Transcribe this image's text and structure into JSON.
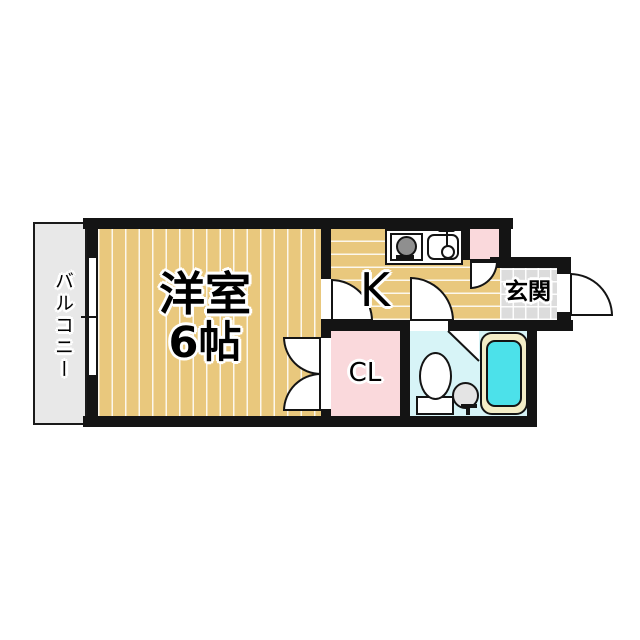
{
  "rooms": {
    "main": {
      "line1": "洋室",
      "line2": "6帖",
      "floor_color": "#e9c87d"
    },
    "kitchen": {
      "label": "K",
      "floor_color": "#e9c87d"
    },
    "closet": {
      "label": "CL",
      "floor_color": "#fad9dc"
    },
    "entrance": {
      "label": "玄関",
      "floor_color": "#dcdcdc"
    },
    "balcony": {
      "label": "バルコニー",
      "floor_color": "#e8e8e8"
    },
    "bathroom": {
      "floor_color": "#d7f4f7"
    },
    "storage_box": {
      "floor_color": "#fad9dc"
    }
  },
  "fixtures": {
    "kitchen_icons": [
      "stove-icon",
      "sink-icon",
      "faucet-icon"
    ],
    "bathroom_icons": [
      "toilet-icon",
      "washbasin-icon",
      "bathtub-icon"
    ],
    "bathtub_water_color": "#4ce1ea",
    "bathtub_rim_color": "#f3edc7",
    "stove_burner_color": "#8f8f8f",
    "washbasin_color": "#e4e4e4"
  },
  "colors": {
    "wall": "#141414",
    "background": "#ffffff"
  }
}
